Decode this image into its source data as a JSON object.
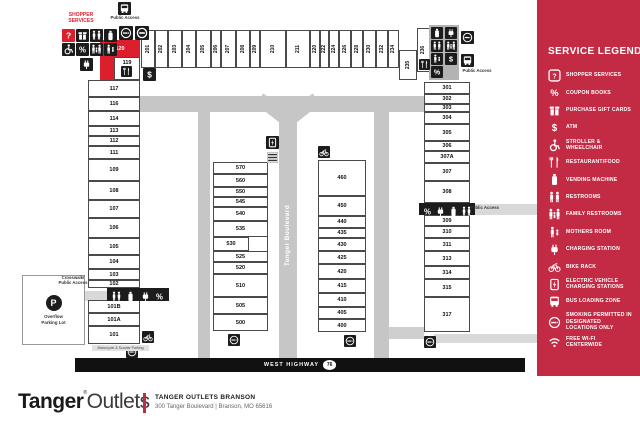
{
  "colors": {
    "sidebar_red": "#c32a44",
    "map_red": "#dd1f2d",
    "dark": "#1c1c1c",
    "road": "#c6c6c6",
    "road_light": "#d9d9d9"
  },
  "legend": {
    "title": "SERVICE LEGEND",
    "items": [
      {
        "icon": "shopper-services",
        "label": "SHOPPER SERVICES"
      },
      {
        "icon": "percent",
        "label": "COUPON BOOKS"
      },
      {
        "icon": "gift",
        "label": "PURCHASE GIFT CARDS"
      },
      {
        "icon": "dollar",
        "label": "ATM"
      },
      {
        "icon": "wheelchair",
        "label": "STROLLER & WHEELCHAIR"
      },
      {
        "icon": "restaurant",
        "label": "RESTAURANT/FOOD"
      },
      {
        "icon": "vending",
        "label": "VENDING MACHINE"
      },
      {
        "icon": "restrooms",
        "label": "RESTROOMS"
      },
      {
        "icon": "family",
        "label": "FAMILY RESTROOMS"
      },
      {
        "icon": "mothers",
        "label": "MOTHERS ROOM"
      },
      {
        "icon": "charging",
        "label": "CHARGING STATION"
      },
      {
        "icon": "bike",
        "label": "BIKE RACK"
      },
      {
        "icon": "ev",
        "label": "ELECTRIC VEHICLE CHARGING STATIONS"
      },
      {
        "icon": "bus",
        "label": "BUS LOADING ZONE"
      },
      {
        "icon": "smoking",
        "label": "SMOKING PERMITTED IN DESIGNATED LOCATIONS ONLY"
      },
      {
        "icon": "wifi",
        "label": "FREE WI-FI CENTERWIDE"
      }
    ]
  },
  "map": {
    "labels": {
      "shopper_services": "SHOPPER SERVICES",
      "public_access": "Public Access",
      "crosswalk_1": "Crosswalk/",
      "crosswalk_2": "Public Access",
      "overflow": "Overflow Parking Lot",
      "motorcycle": "Motorcycle & Scooter Parking",
      "boulevard": "Tanger Boulevard",
      "highway": "WEST HIGHWAY",
      "highway_number": "76"
    },
    "store_groups": [
      {
        "id": "top-row",
        "vertical": true,
        "boxes": [
          {
            "n": "201",
            "x": 141,
            "y": 30,
            "w": 14,
            "h": 38
          },
          {
            "n": "202",
            "x": 155,
            "y": 30,
            "w": 13,
            "h": 38
          },
          {
            "n": "203",
            "x": 168,
            "y": 30,
            "w": 14,
            "h": 38
          },
          {
            "n": "204",
            "x": 182,
            "y": 30,
            "w": 14,
            "h": 38
          },
          {
            "n": "205",
            "x": 196,
            "y": 30,
            "w": 15,
            "h": 38
          },
          {
            "n": "206",
            "x": 211,
            "y": 30,
            "w": 10,
            "h": 38
          },
          {
            "n": "207",
            "x": 221,
            "y": 30,
            "w": 15,
            "h": 38
          },
          {
            "n": "208",
            "x": 236,
            "y": 30,
            "w": 14,
            "h": 38
          },
          {
            "n": "209",
            "x": 250,
            "y": 30,
            "w": 10,
            "h": 38
          },
          {
            "n": "210",
            "x": 260,
            "y": 30,
            "w": 26,
            "h": 38
          },
          {
            "n": "211",
            "x": 286,
            "y": 30,
            "w": 24,
            "h": 38
          },
          {
            "n": "220",
            "x": 310,
            "y": 30,
            "w": 10,
            "h": 38
          },
          {
            "n": "222",
            "x": 320,
            "y": 30,
            "w": 9,
            "h": 38
          },
          {
            "n": "224",
            "x": 329,
            "y": 30,
            "w": 10,
            "h": 38
          },
          {
            "n": "226",
            "x": 339,
            "y": 30,
            "w": 12,
            "h": 38
          },
          {
            "n": "228",
            "x": 351,
            "y": 30,
            "w": 12,
            "h": 38
          },
          {
            "n": "230",
            "x": 363,
            "y": 30,
            "w": 13,
            "h": 38
          },
          {
            "n": "232",
            "x": 376,
            "y": 30,
            "w": 12,
            "h": 38
          },
          {
            "n": "234",
            "x": 388,
            "y": 30,
            "w": 11,
            "h": 38
          },
          {
            "n": "235",
            "x": 399,
            "y": 50,
            "w": 18,
            "h": 30
          },
          {
            "n": "236",
            "x": 417,
            "y": 28,
            "w": 13,
            "h": 44
          }
        ]
      },
      {
        "id": "left-column",
        "boxes": [
          {
            "n": "117",
            "x": 88,
            "y": 80,
            "w": 52,
            "h": 17
          },
          {
            "n": "116",
            "x": 88,
            "y": 97,
            "w": 52,
            "h": 14
          },
          {
            "n": "114",
            "x": 88,
            "y": 111,
            "w": 52,
            "h": 15
          },
          {
            "n": "113",
            "x": 88,
            "y": 126,
            "w": 52,
            "h": 10
          },
          {
            "n": "112",
            "x": 88,
            "y": 136,
            "w": 52,
            "h": 10
          },
          {
            "n": "111",
            "x": 88,
            "y": 146,
            "w": 52,
            "h": 13
          },
          {
            "n": "109",
            "x": 88,
            "y": 159,
            "w": 52,
            "h": 22
          },
          {
            "n": "108",
            "x": 88,
            "y": 181,
            "w": 52,
            "h": 19
          },
          {
            "n": "107",
            "x": 88,
            "y": 200,
            "w": 52,
            "h": 18
          },
          {
            "n": "106",
            "x": 88,
            "y": 218,
            "w": 52,
            "h": 20
          },
          {
            "n": "105",
            "x": 88,
            "y": 238,
            "w": 52,
            "h": 17
          },
          {
            "n": "104",
            "x": 88,
            "y": 255,
            "w": 52,
            "h": 14
          },
          {
            "n": "103",
            "x": 88,
            "y": 269,
            "w": 52,
            "h": 11
          },
          {
            "n": "102",
            "x": 88,
            "y": 280,
            "w": 52,
            "h": 8
          },
          {
            "n": "101B",
            "x": 88,
            "y": 300,
            "w": 52,
            "h": 13
          },
          {
            "n": "101A",
            "x": 88,
            "y": 313,
            "w": 52,
            "h": 13
          },
          {
            "n": "101",
            "x": 88,
            "y": 326,
            "w": 52,
            "h": 18
          }
        ]
      },
      {
        "id": "right-column",
        "boxes": [
          {
            "n": "301",
            "x": 424,
            "y": 82,
            "w": 46,
            "h": 12
          },
          {
            "n": "302",
            "x": 424,
            "y": 94,
            "w": 46,
            "h": 10
          },
          {
            "n": "303",
            "x": 424,
            "y": 104,
            "w": 46,
            "h": 8
          },
          {
            "n": "304",
            "x": 424,
            "y": 112,
            "w": 46,
            "h": 12
          },
          {
            "n": "305",
            "x": 424,
            "y": 124,
            "w": 46,
            "h": 17
          },
          {
            "n": "306",
            "x": 424,
            "y": 141,
            "w": 46,
            "h": 10
          },
          {
            "n": "307A",
            "x": 424,
            "y": 151,
            "w": 46,
            "h": 12
          },
          {
            "n": "307",
            "x": 424,
            "y": 163,
            "w": 46,
            "h": 18
          },
          {
            "n": "308",
            "x": 424,
            "y": 181,
            "w": 46,
            "h": 22
          },
          {
            "n": "309",
            "x": 424,
            "y": 215,
            "w": 46,
            "h": 11
          },
          {
            "n": "310",
            "x": 424,
            "y": 226,
            "w": 46,
            "h": 12
          },
          {
            "n": "311",
            "x": 424,
            "y": 238,
            "w": 46,
            "h": 13
          },
          {
            "n": "313",
            "x": 424,
            "y": 251,
            "w": 46,
            "h": 15
          },
          {
            "n": "314",
            "x": 424,
            "y": 266,
            "w": 46,
            "h": 13
          },
          {
            "n": "315",
            "x": 424,
            "y": 279,
            "w": 46,
            "h": 18
          },
          {
            "n": "317",
            "x": 424,
            "y": 297,
            "w": 46,
            "h": 35
          }
        ]
      },
      {
        "id": "center-left",
        "boxes": [
          {
            "n": "570",
            "x": 213,
            "y": 162,
            "w": 55,
            "h": 12
          },
          {
            "n": "560",
            "x": 213,
            "y": 174,
            "w": 55,
            "h": 13
          },
          {
            "n": "550",
            "x": 213,
            "y": 187,
            "w": 55,
            "h": 10
          },
          {
            "n": "545",
            "x": 213,
            "y": 197,
            "w": 55,
            "h": 10
          },
          {
            "n": "540",
            "x": 213,
            "y": 207,
            "w": 55,
            "h": 14
          },
          {
            "n": "535",
            "x": 213,
            "y": 221,
            "w": 55,
            "h": 16
          },
          {
            "n": "530",
            "x": 213,
            "y": 237,
            "w": 36,
            "h": 14
          },
          {
            "n": "525",
            "x": 213,
            "y": 251,
            "w": 55,
            "h": 11
          },
          {
            "n": "520",
            "x": 213,
            "y": 262,
            "w": 55,
            "h": 12
          },
          {
            "n": "510",
            "x": 213,
            "y": 274,
            "w": 55,
            "h": 23
          },
          {
            "n": "505",
            "x": 213,
            "y": 297,
            "w": 55,
            "h": 17
          },
          {
            "n": "500",
            "x": 213,
            "y": 314,
            "w": 55,
            "h": 17
          }
        ]
      },
      {
        "id": "center-right",
        "boxes": [
          {
            "n": "460",
            "x": 318,
            "y": 160,
            "w": 48,
            "h": 36
          },
          {
            "n": "450",
            "x": 318,
            "y": 196,
            "w": 48,
            "h": 20
          },
          {
            "n": "440",
            "x": 318,
            "y": 216,
            "w": 48,
            "h": 12
          },
          {
            "n": "435",
            "x": 318,
            "y": 228,
            "w": 48,
            "h": 10
          },
          {
            "n": "430",
            "x": 318,
            "y": 238,
            "w": 48,
            "h": 13
          },
          {
            "n": "425",
            "x": 318,
            "y": 251,
            "w": 48,
            "h": 13
          },
          {
            "n": "420",
            "x": 318,
            "y": 264,
            "w": 48,
            "h": 15
          },
          {
            "n": "415",
            "x": 318,
            "y": 279,
            "w": 48,
            "h": 14
          },
          {
            "n": "410",
            "x": 318,
            "y": 293,
            "w": 48,
            "h": 14
          },
          {
            "n": "405",
            "x": 318,
            "y": 307,
            "w": 48,
            "h": 12
          },
          {
            "n": "400",
            "x": 318,
            "y": 319,
            "w": 48,
            "h": 13
          }
        ]
      },
      {
        "id": "anchor",
        "boxes": [
          {
            "n": "120",
            "x": 100,
            "y": 40,
            "w": 40,
            "h": 40,
            "cls": "red"
          },
          {
            "n": "119",
            "x": 114,
            "y": 57,
            "w": 26,
            "h": 23,
            "cls": "over"
          }
        ]
      }
    ],
    "outlines": [
      {
        "x": 213,
        "y": 162,
        "w": 55,
        "h": 169
      },
      {
        "x": 318,
        "y": 160,
        "w": 48,
        "h": 172
      }
    ],
    "bars": [
      {
        "x": 107,
        "y": 288,
        "w": 62,
        "h": 13,
        "icons": [
          "restrooms",
          "vending",
          "charging",
          "percent"
        ]
      },
      {
        "x": 419,
        "y": 203,
        "w": 56,
        "h": 12,
        "icons": [
          "percent",
          "charging",
          "vending",
          "restrooms"
        ]
      }
    ],
    "markers": [
      {
        "icon": "bus",
        "x": 118,
        "y": 2,
        "s": 13,
        "bg": "dark"
      },
      {
        "icon": "smoking",
        "x": 119,
        "y": 26,
        "s": 14,
        "bg": "dark"
      },
      {
        "icon": "noentry",
        "x": 135,
        "y": 26,
        "s": 14,
        "bg": "dark"
      },
      {
        "icon": "question",
        "x": 62,
        "y": 29,
        "s": 13,
        "bg": "red"
      },
      {
        "icon": "gift",
        "x": 76,
        "y": 29,
        "s": 13,
        "bg": "dark"
      },
      {
        "icon": "restrooms",
        "x": 90,
        "y": 29,
        "s": 13,
        "bg": "dark"
      },
      {
        "icon": "vending",
        "x": 104,
        "y": 29,
        "s": 13,
        "bg": "dark"
      },
      {
        "icon": "wheelchair",
        "x": 62,
        "y": 43,
        "s": 13,
        "bg": "dark"
      },
      {
        "icon": "percent",
        "x": 76,
        "y": 43,
        "s": 13,
        "bg": "dark"
      },
      {
        "icon": "family",
        "x": 90,
        "y": 43,
        "s": 13,
        "bg": "dark"
      },
      {
        "icon": "mothers",
        "x": 104,
        "y": 43,
        "s": 13,
        "bg": "dark"
      },
      {
        "icon": "charging",
        "x": 80,
        "y": 58,
        "s": 13,
        "bg": "dark"
      },
      {
        "icon": "restaurant",
        "x": 121,
        "y": 66,
        "s": 11,
        "bg": "dark"
      },
      {
        "icon": "dollar",
        "x": 143,
        "y": 68,
        "s": 13,
        "bg": "dark"
      },
      {
        "icon": "ev",
        "x": 266,
        "y": 136,
        "s": 13,
        "bg": "dark"
      },
      {
        "icon": "evspaces",
        "x": 266,
        "y": 151,
        "s": 13,
        "bg": "none"
      },
      {
        "icon": "bike",
        "x": 318,
        "y": 146,
        "s": 12,
        "bg": "dark"
      },
      {
        "icon": "restaurant",
        "x": 419,
        "y": 59,
        "s": 11,
        "bg": "dark"
      },
      {
        "icon": "vending",
        "x": 431,
        "y": 27,
        "s": 12,
        "bg": "dark"
      },
      {
        "icon": "charging",
        "x": 445,
        "y": 27,
        "s": 12,
        "bg": "dark"
      },
      {
        "icon": "restrooms",
        "x": 431,
        "y": 40,
        "s": 12,
        "bg": "dark"
      },
      {
        "icon": "family",
        "x": 445,
        "y": 40,
        "s": 12,
        "bg": "dark"
      },
      {
        "icon": "mothers",
        "x": 431,
        "y": 53,
        "s": 12,
        "bg": "dark"
      },
      {
        "icon": "dollar",
        "x": 445,
        "y": 53,
        "s": 12,
        "bg": "dark"
      },
      {
        "icon": "percent",
        "x": 431,
        "y": 66,
        "s": 12,
        "bg": "dark"
      },
      {
        "icon": "smoking",
        "x": 461,
        "y": 31,
        "s": 13,
        "bg": "dark"
      },
      {
        "icon": "bus",
        "x": 461,
        "y": 54,
        "s": 13,
        "bg": "dark"
      },
      {
        "icon": "smoking",
        "x": 228,
        "y": 334,
        "s": 12,
        "bg": "dark"
      },
      {
        "icon": "smoking",
        "x": 344,
        "y": 335,
        "s": 12,
        "bg": "dark"
      },
      {
        "icon": "bike",
        "x": 142,
        "y": 331,
        "s": 12,
        "bg": "dark"
      },
      {
        "icon": "smoking",
        "x": 126,
        "y": 346,
        "s": 12,
        "bg": "dark"
      },
      {
        "icon": "smoking",
        "x": 424,
        "y": 336,
        "s": 12,
        "bg": "dark"
      }
    ]
  },
  "footer": {
    "brand_bold": "Tanger",
    "brand_reg": "®",
    "brand_light": "Outlets",
    "center_name": "TANGER OUTLETS BRANSON",
    "address": "300 Tanger Boulevard  |  Branson, MO 65616"
  }
}
